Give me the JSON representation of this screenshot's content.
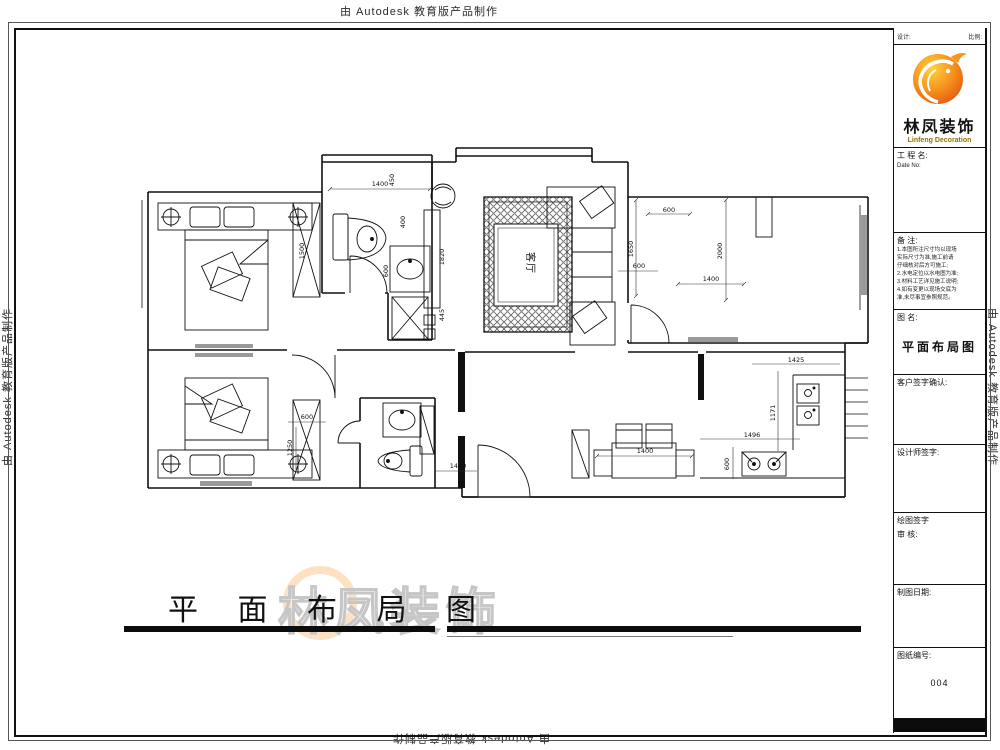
{
  "watermark": {
    "text": "由 Autodesk 教育版产品制作"
  },
  "brand": {
    "name_cn": "林凤装饰",
    "name_en": "Linfeng Decoration",
    "accent": "#f7941d"
  },
  "titlebar": {
    "title": "平面布局图",
    "title_spaced": "平 面 布 局 图"
  },
  "sidebar": {
    "top_left": "设计:",
    "top_right": "比例:",
    "project": {
      "label": "工 程 名:",
      "sub": "Date No:"
    },
    "notes": {
      "label": "备 注:",
      "lines": [
        "1.本图所注尺寸均以现场",
        "实际尺寸为准,施工前请",
        "仔细核对后方可施工;",
        "2.水电定位以水电图为准;",
        "3.材料工艺详见施工说明;",
        "4.如有变更以现场交底为",
        "准,未尽事宜参照规范。"
      ]
    },
    "drawing": {
      "label": "图 名:",
      "value": "平面布局图"
    },
    "client_sign": "客户签字确认:",
    "designer_sign": "设计师签字:",
    "draft_sign": "绘图签字",
    "review": "审  核:",
    "date_label": "制图日期:",
    "number": {
      "label": "图纸编号:",
      "value": "004"
    }
  },
  "plan": {
    "room_label": "客厅",
    "dims": [
      "1400",
      "450",
      "400",
      "600",
      "1820",
      "445",
      "1500",
      "600",
      "1650",
      "600",
      "2000",
      "1400",
      "1425",
      "1171",
      "1496",
      "600",
      "1400",
      "600",
      "1250",
      "1400"
    ]
  }
}
